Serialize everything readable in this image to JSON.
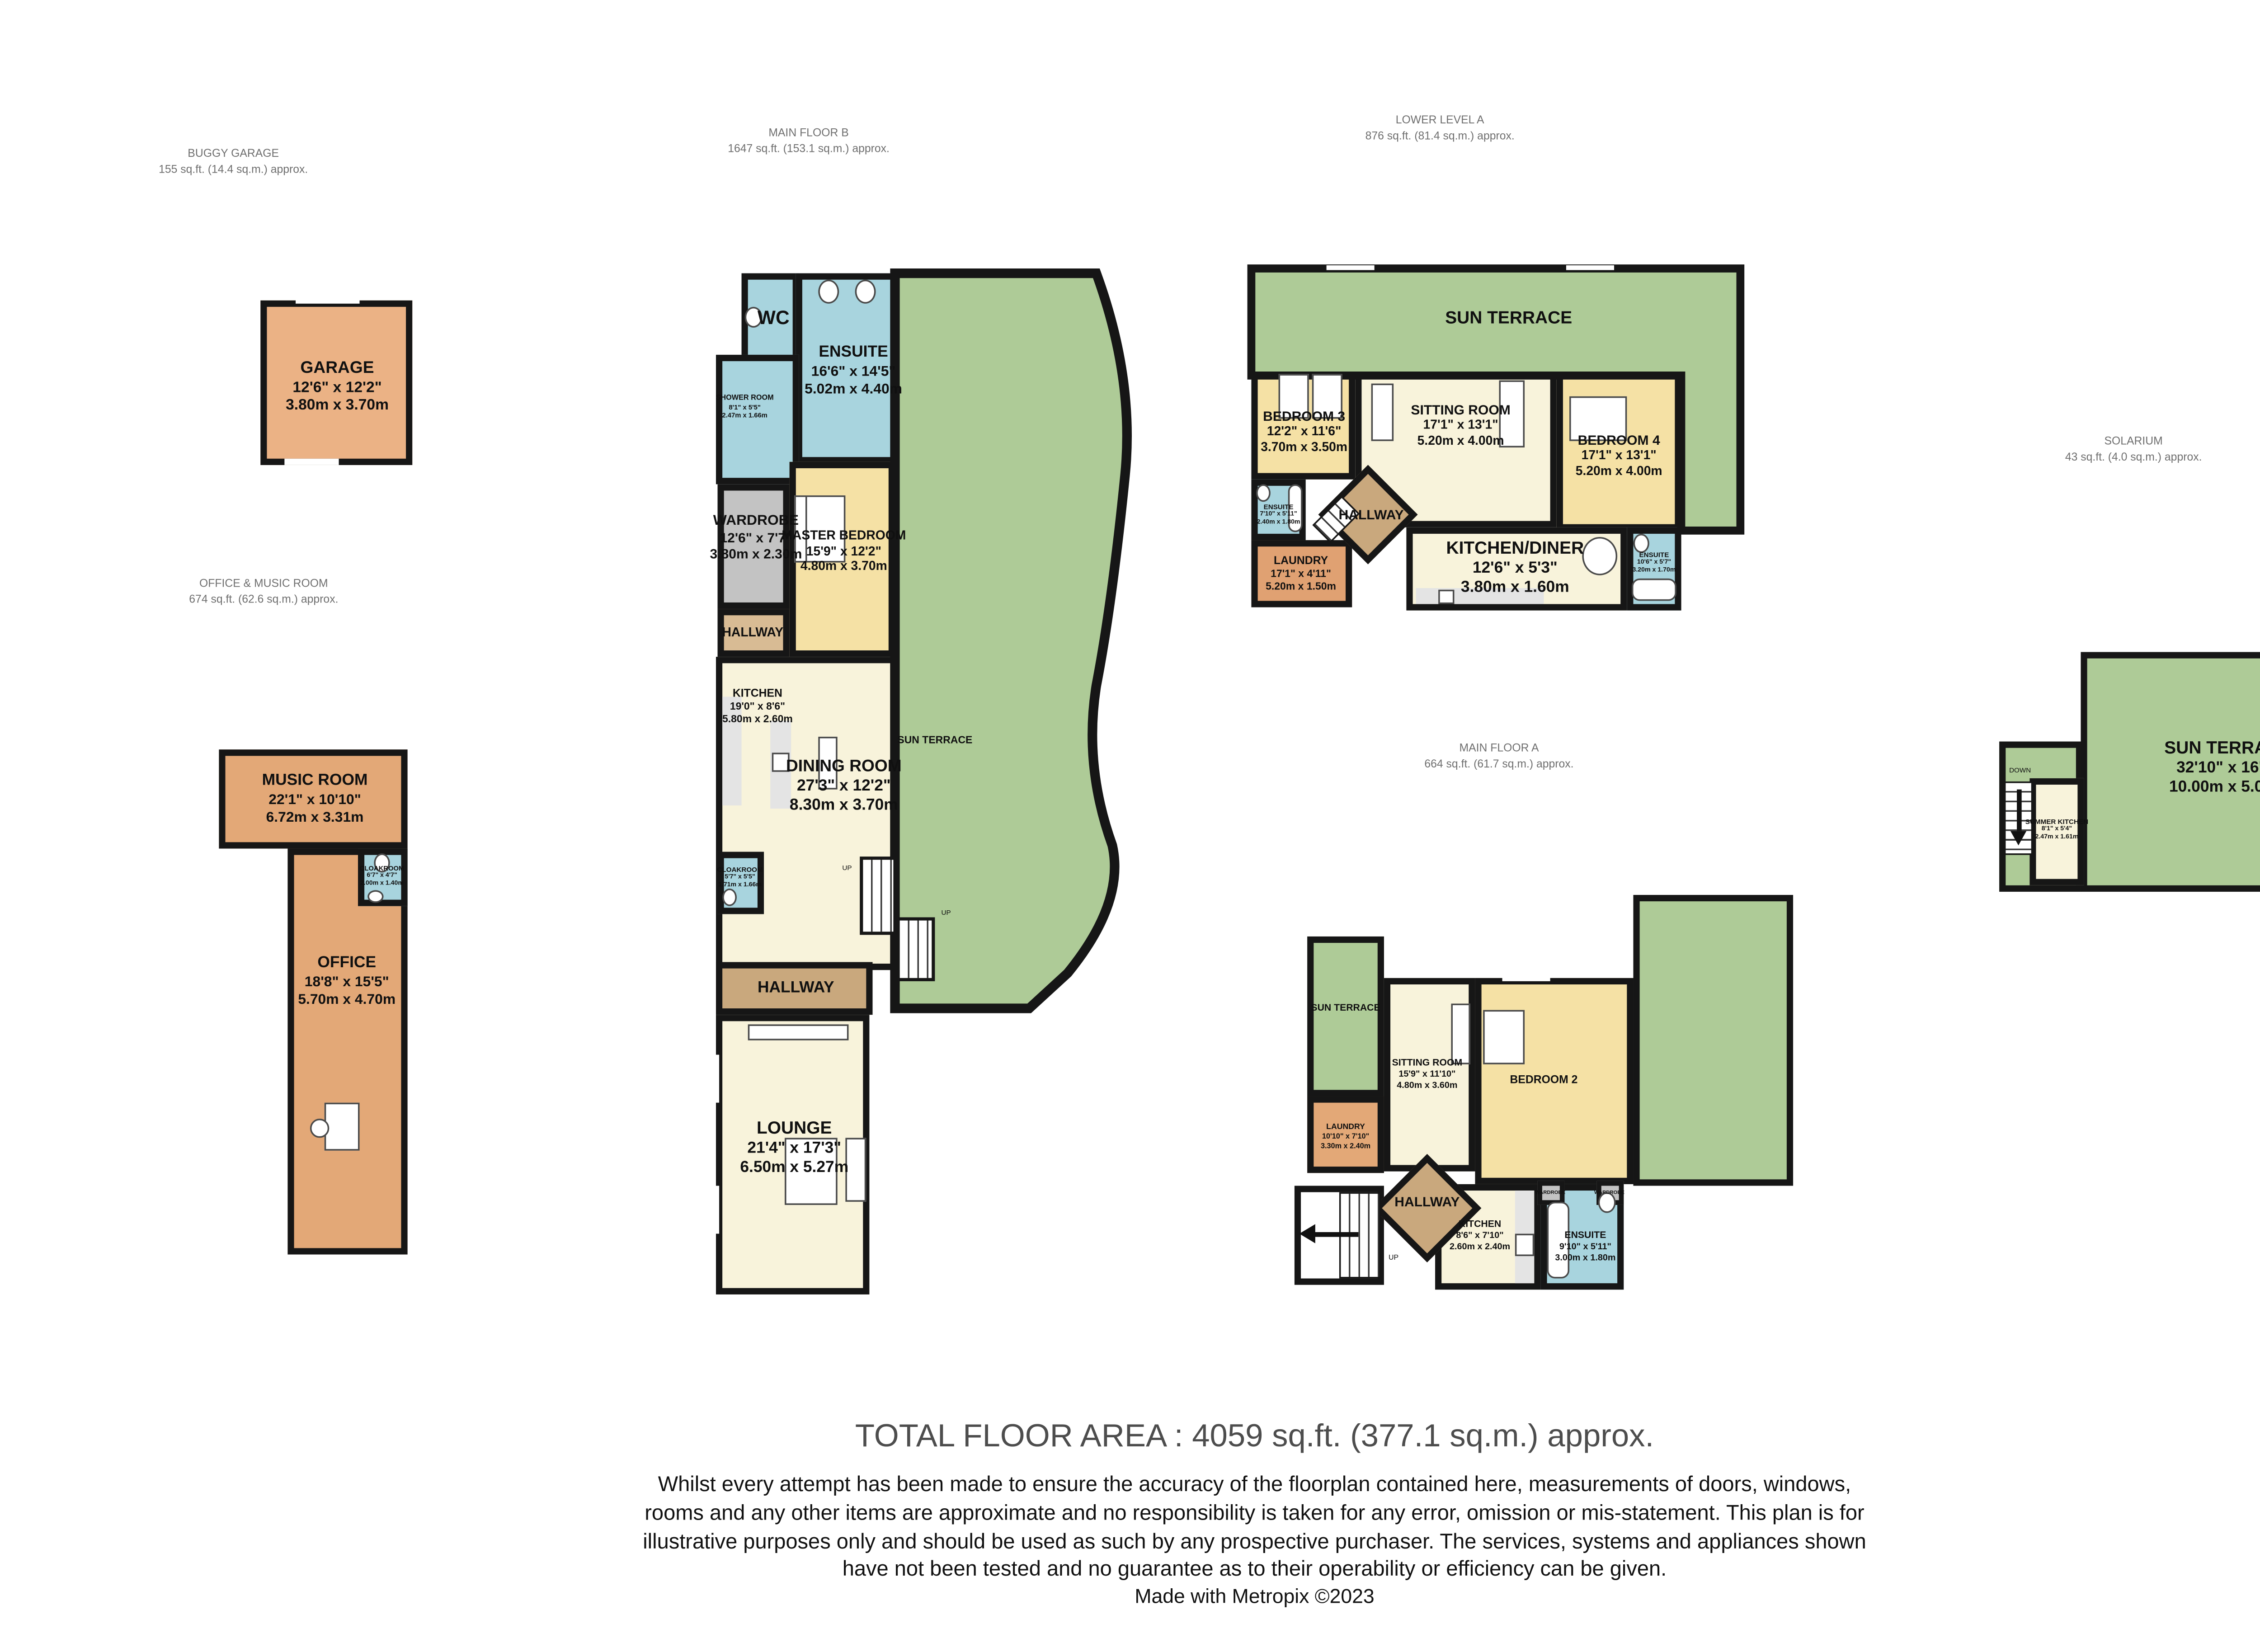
{
  "title_block": {
    "total_area": "TOTAL FLOOR AREA : 4059 sq.ft. (377.1 sq.m.) approx.",
    "disclaimer": "Whilst every attempt has been made to ensure the accuracy of the floorplan contained here, measurements of doors, windows, rooms and any other items are approximate and no responsibility is taken for any error, omission or mis-statement. This plan is for illustrative purposes only and should be used as such by any prospective purchaser. The services, systems and appliances shown have not been tested and no guarantee as to their operability or efficiency can be given.",
    "credit": "Made with Metropix ©2023"
  },
  "sections": {
    "buggy_garage": {
      "name": "BUGGY GARAGE",
      "area": "155 sq.ft. (14.4 sq.m.) approx."
    },
    "main_floor_b": {
      "name": "MAIN FLOOR B",
      "area": "1647 sq.ft. (153.1 sq.m.) approx."
    },
    "lower_level_a": {
      "name": "LOWER LEVEL A",
      "area": "876 sq.ft. (81.4 sq.m.) approx."
    },
    "solarium": {
      "name": "SOLARIUM",
      "area": "43 sq.ft. (4.0 sq.m.) approx."
    },
    "office_music": {
      "name": "OFFICE & MUSIC ROOM",
      "area": "674 sq.ft. (62.6 sq.m.) approx."
    },
    "main_floor_a": {
      "name": "MAIN FLOOR A",
      "area": "664 sq.ft. (61.7 sq.m.) approx."
    }
  },
  "rooms": {
    "garage": {
      "name": "GARAGE",
      "imperial": "12'6\" x 12'2\"",
      "metric": "3.80m x 3.70m"
    },
    "wc": {
      "name": "WC"
    },
    "ensuite_b": {
      "name": "ENSUITE",
      "imperial": "16'6\" x 14'5\"",
      "metric": "5.02m x 4.40m"
    },
    "shower_room": {
      "name": "SHOWER ROOM",
      "imperial": "8'1\" x 5'5\"",
      "metric": "2.47m x 1.66m"
    },
    "wardrobe_b": {
      "name": "WARDROBE",
      "imperial": "12'6\" x 7'7\"",
      "metric": "3.80m x 2.30m"
    },
    "master_bedroom": {
      "name": "MASTER BEDROOM",
      "imperial": "15'9\" x 12'2\"",
      "metric": "4.80m x 3.70m"
    },
    "hallway_b1": {
      "name": "HALLWAY"
    },
    "kitchen_b": {
      "name": "KITCHEN",
      "imperial": "19'0\" x 8'6\"",
      "metric": "5.80m x 2.60m"
    },
    "dining_room": {
      "name": "DINING ROOM",
      "imperial": "27'3\" x 12'2\"",
      "metric": "8.30m x 3.70m"
    },
    "sun_terrace_b": {
      "name": "SUN TERRACE"
    },
    "cloakroom_b": {
      "name": "CLOAKROOM",
      "imperial": "5'7\" x 5'5\"",
      "metric": "1.71m x 1.66m"
    },
    "hallway_b2": {
      "name": "HALLWAY"
    },
    "lounge": {
      "name": "LOUNGE",
      "imperial": "21'4\" x 17'3\"",
      "metric": "6.50m x 5.27m"
    },
    "sun_terrace_la": {
      "name": "SUN TERRACE"
    },
    "bedroom3": {
      "name": "BEDROOM 3",
      "imperial": "12'2\" x 11'6\"",
      "metric": "3.70m x 3.50m"
    },
    "sitting_room_la": {
      "name": "SITTING ROOM",
      "imperial": "17'1\" x 13'1\"",
      "metric": "5.20m x 4.00m"
    },
    "bedroom4": {
      "name": "BEDROOM 4",
      "imperial": "17'1\" x 13'1\"",
      "metric": "5.20m x 4.00m"
    },
    "ensuite_la1": {
      "name": "ENSUITE",
      "imperial": "7'10\" x 5'11\"",
      "metric": "2.40m x 1.80m"
    },
    "hallway_la": {
      "name": "HALLWAY"
    },
    "laundry_la": {
      "name": "LAUNDRY",
      "imperial": "17'1\" x 4'11\"",
      "metric": "5.20m x 1.50m"
    },
    "kitchen_diner": {
      "name": "KITCHEN/DINER",
      "imperial": "12'6\" x 5'3\"",
      "metric": "3.80m x 1.60m"
    },
    "ensuite_la2": {
      "name": "ENSUITE",
      "imperial": "10'6\" x 5'7\"",
      "metric": "3.20m x 1.70m"
    },
    "music_room": {
      "name": "MUSIC ROOM",
      "imperial": "22'1\" x 10'10\"",
      "metric": "6.72m x 3.31m"
    },
    "cloakroom_om": {
      "name": "CLOAKROOM",
      "imperial": "6'7\" x 4'7\"",
      "metric": "2.00m x 1.40m"
    },
    "office": {
      "name": "OFFICE",
      "imperial": "18'8\" x 15'5\"",
      "metric": "5.70m x 4.70m"
    },
    "sun_terrace_ma": {
      "name": "SUN TERRACE"
    },
    "sitting_room_ma": {
      "name": "SITTING ROOM",
      "imperial": "15'9\" x 11'10\"",
      "metric": "4.80m x 3.60m"
    },
    "bedroom2": {
      "name": "BEDROOM 2"
    },
    "laundry_ma": {
      "name": "LAUNDRY",
      "imperial": "10'10\" x 7'10\"",
      "metric": "3.30m x 2.40m"
    },
    "hallway_ma": {
      "name": "HALLWAY"
    },
    "kitchen_ma": {
      "name": "KITCHEN",
      "imperial": "8'6\" x 7'10\"",
      "metric": "2.60m x 2.40m"
    },
    "ensuite_ma": {
      "name": "ENSUITE",
      "imperial": "9'10\" x 5'11\"",
      "metric": "3.00m x 1.80m"
    },
    "wardrobe_ma1": {
      "name": "WARDROBE"
    },
    "wardrobe_ma2": {
      "name": "WARDROBE"
    },
    "sun_terrace_sol": {
      "name": "SUN TERRACE",
      "imperial": "32'10\" x 16'5\"",
      "metric": "10.00m x 5.00m"
    },
    "summer_kitchen": {
      "name": "SUMMER KITCHEN",
      "imperial": "8'1\" x 5'4\"",
      "metric": "2.47m x 1.61m"
    }
  },
  "annotations": {
    "up": "UP",
    "down": "DOWN"
  },
  "colors": {
    "wall": "#161616",
    "terrace_green": "#AECB97",
    "bathroom_blue": "#A8D4DE",
    "bedroom_yellow": "#F5E1A5",
    "living_cream": "#F8F3DB",
    "office_orange": "#E3A877",
    "hallway_tan": "#C9A87D",
    "wardrobe_gray": "#C3C3C3"
  }
}
